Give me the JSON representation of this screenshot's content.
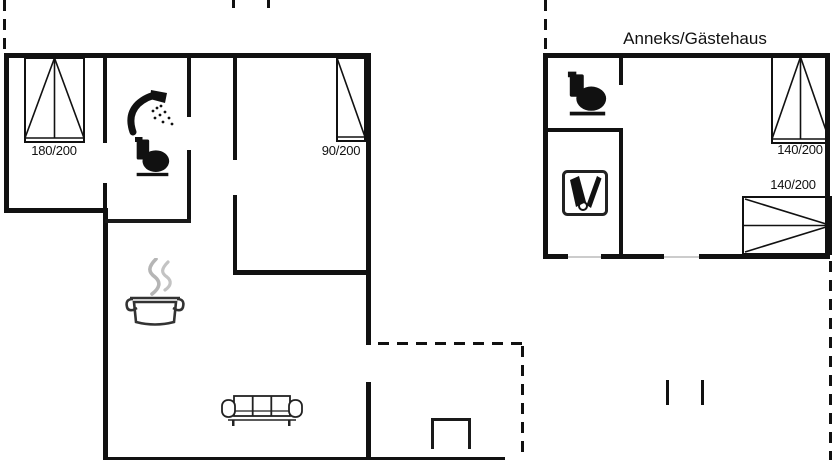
{
  "annex": {
    "title": "Anneks/Gästehaus"
  },
  "beds": [
    {
      "label": "180/200"
    },
    {
      "label": "90/200"
    },
    {
      "label": "140/200"
    },
    {
      "label": "140/200"
    }
  ],
  "icons": [
    "shower-icon",
    "toilet-icon",
    "toilet-icon",
    "cooking-pot-icon",
    "sofa-icon",
    "sauna-box-icon",
    "double-bed-symbol",
    "single-bed-symbol"
  ],
  "colors": {
    "wall": "#111111",
    "steam": "#b5b5b5",
    "threshold": "#cccccc",
    "background": "#ffffff"
  }
}
